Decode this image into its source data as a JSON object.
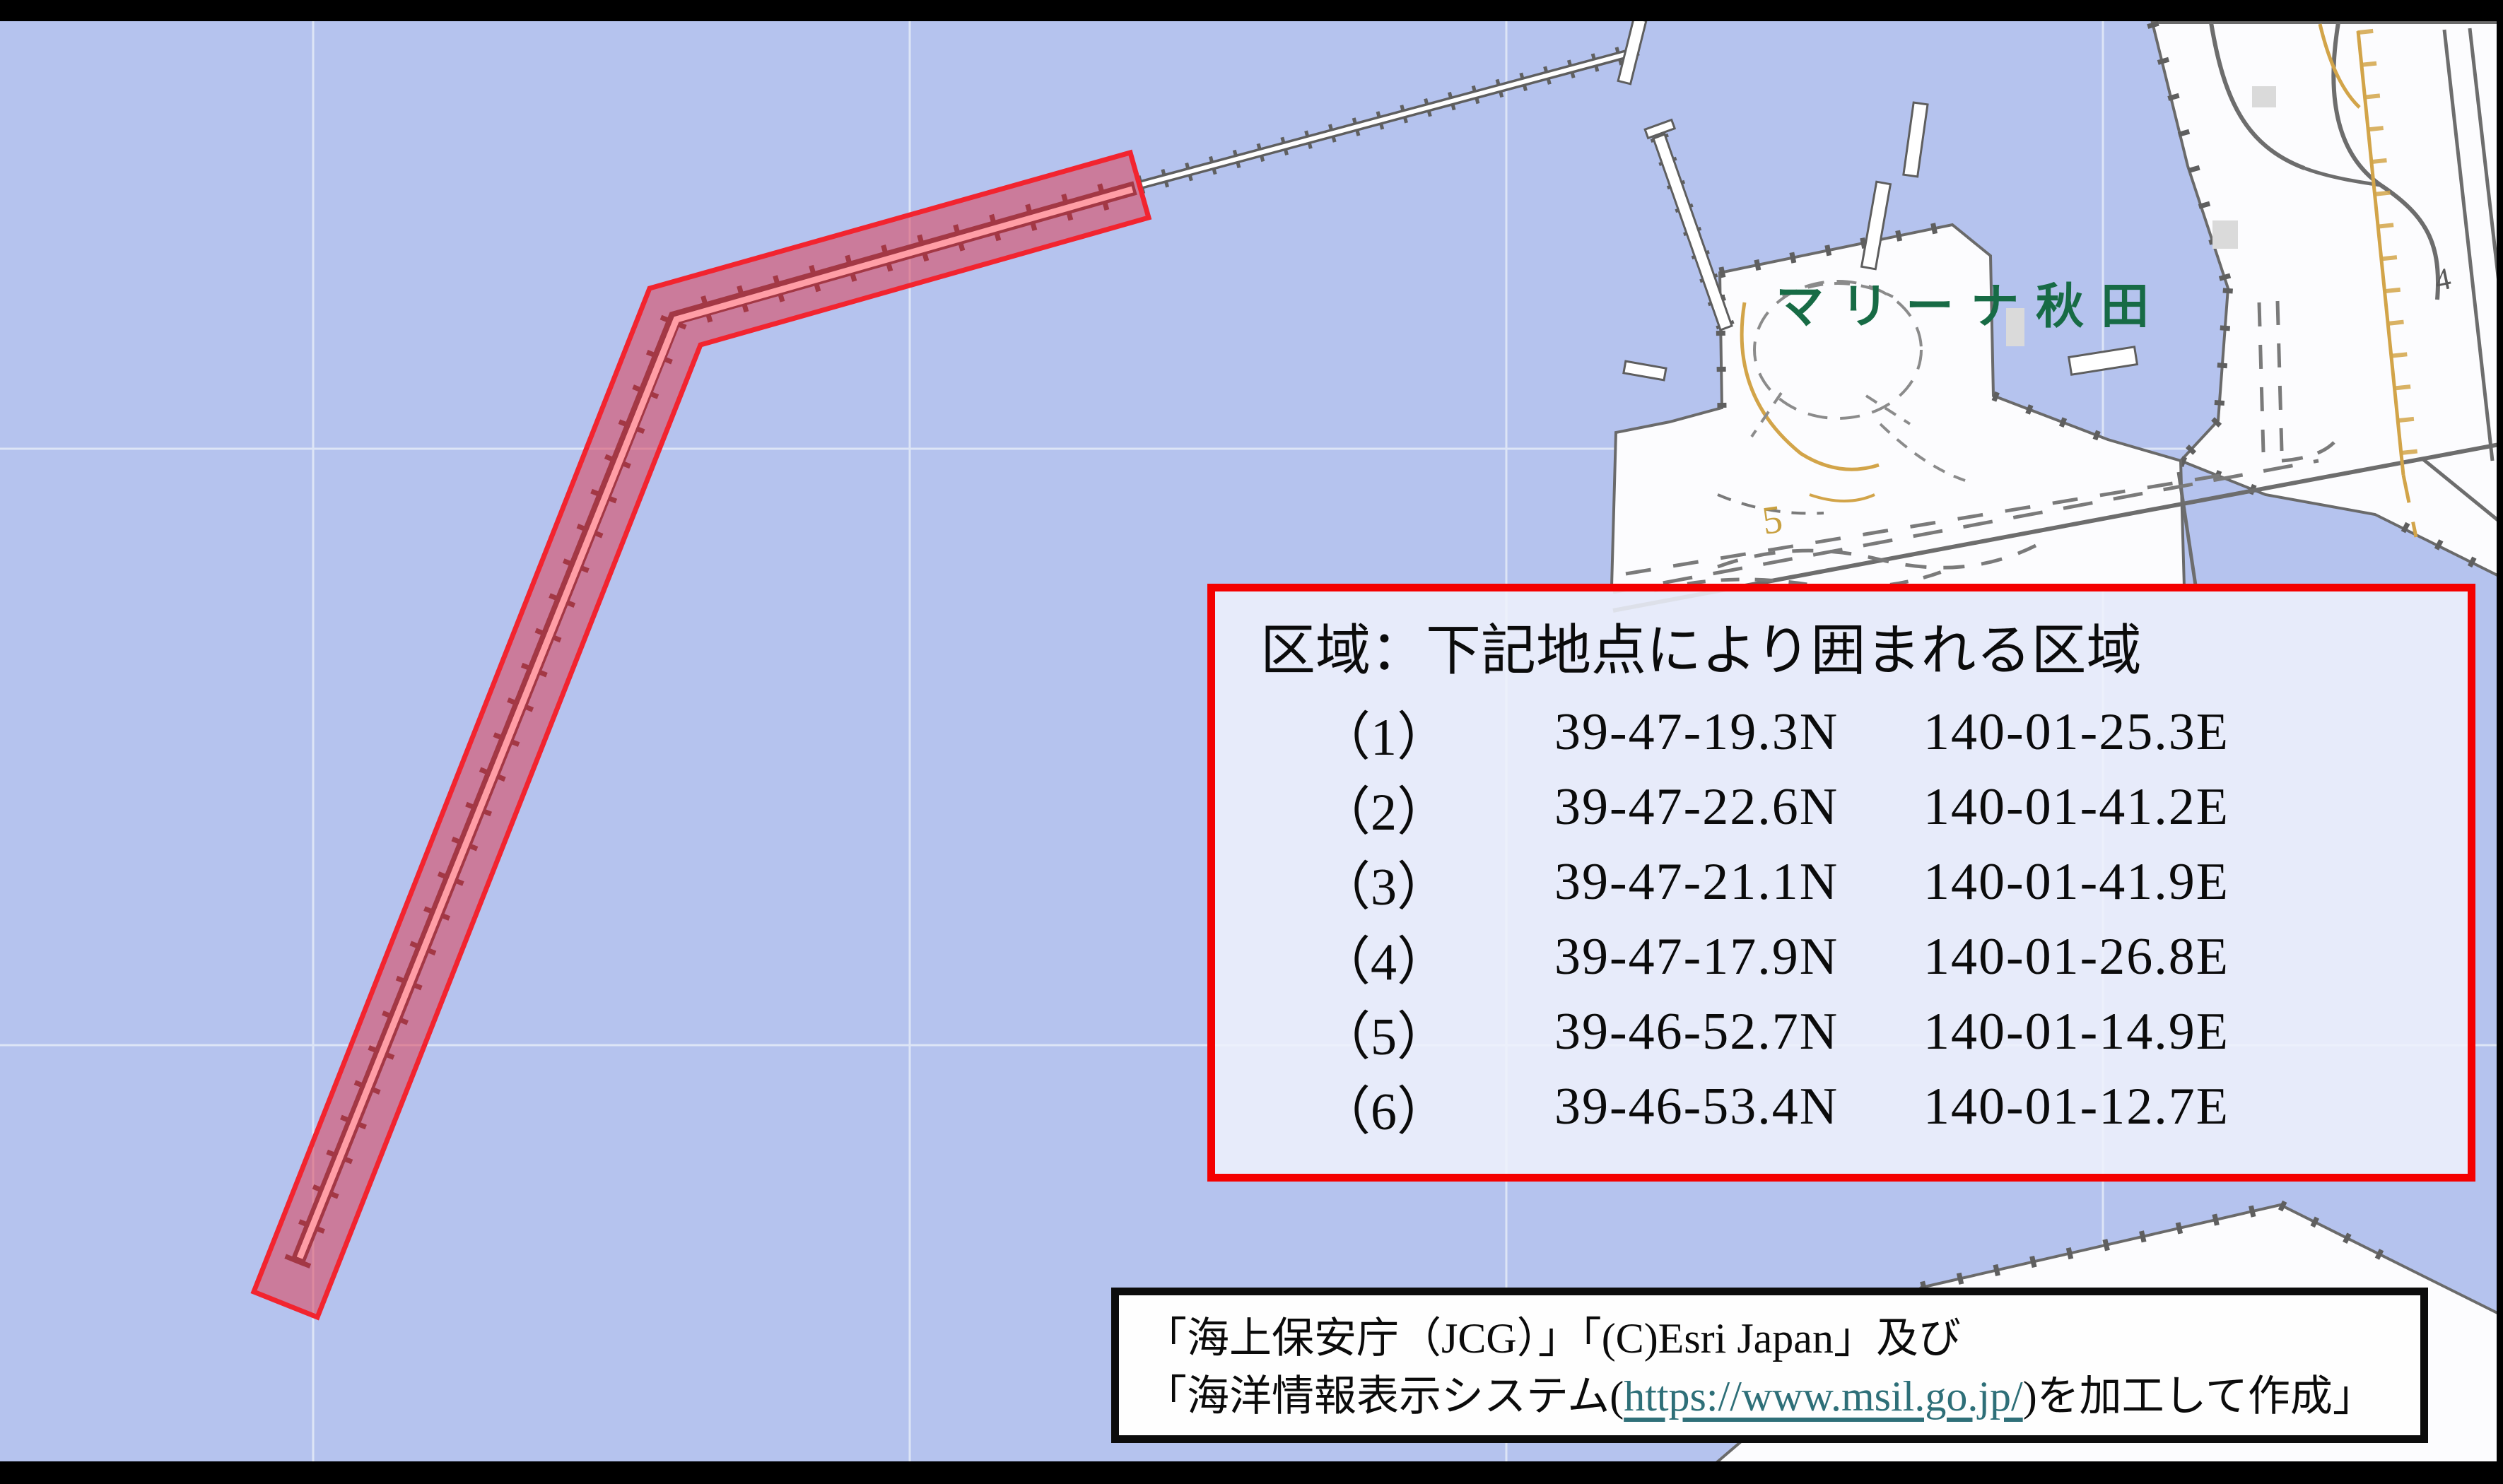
{
  "map": {
    "labels": {
      "marina": "マリーナ秋田",
      "depth_5": "5",
      "depth_4": "4"
    },
    "colors": {
      "sea": "#b5c3ee",
      "gridline": "#dde5f6",
      "land": "#fcfcfe",
      "land_outline": "#6a6a6a",
      "restricted_area_fill": "rgba(221,64,87,0.55)",
      "restricted_area_border": "#f2242f",
      "breakwater_dark": "#a33845",
      "breakwater_core": "#ff9ea6",
      "marina_label_green": "#176b45",
      "contour_tan": "#d2a449"
    }
  },
  "region_box": {
    "title": "区域：下記地点により囲まれる区域",
    "border_color": "#f40000",
    "points": [
      {
        "label": "（1）",
        "lat": "39-47-19.3N",
        "lon": "140-01-25.3E"
      },
      {
        "label": "（2）",
        "lat": "39-47-22.6N",
        "lon": "140-01-41.2E"
      },
      {
        "label": "（3）",
        "lat": "39-47-21.1N",
        "lon": "140-01-41.9E"
      },
      {
        "label": "（4）",
        "lat": "39-47-17.9N",
        "lon": "140-01-26.8E"
      },
      {
        "label": "（5）",
        "lat": "39-46-52.7N",
        "lon": "140-01-14.9E"
      },
      {
        "label": "（6）",
        "lat": "39-46-53.4N",
        "lon": "140-01-12.7E"
      }
    ]
  },
  "attribution_box": {
    "line1": "「海上保安庁（JCG）」「(C)Esri Japan」及び",
    "line2_prefix": "「海洋情報表示システム(",
    "line2_link": "https://www.msil.go.jp/",
    "line2_suffix": ")を加工して作成」",
    "link_color": "#2e6f78"
  }
}
